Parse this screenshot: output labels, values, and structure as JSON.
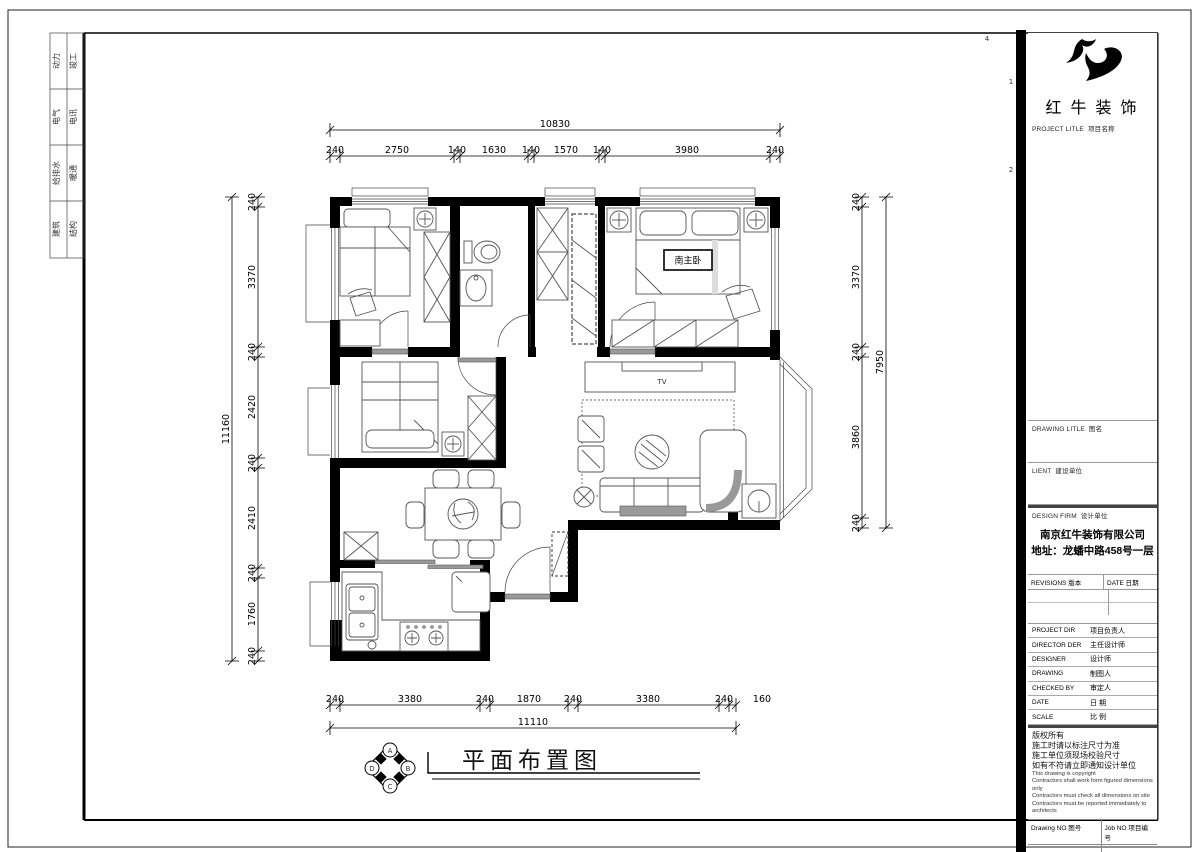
{
  "drawing": {
    "sheet_title": "平面布置图",
    "master_bedroom_label": "南主卧",
    "tv_label": "TV"
  },
  "dims": {
    "top": {
      "total": "10830",
      "segments": [
        "240",
        "2750",
        "140",
        "1630",
        "140",
        "1570",
        "140",
        "3980",
        "240"
      ]
    },
    "bottom": {
      "total": "11110",
      "segments": [
        "240",
        "3380",
        "240",
        "1870",
        "240",
        "3380",
        "240",
        "160"
      ]
    },
    "left": {
      "total": "11160",
      "segments": [
        "240",
        "3370",
        "240",
        "2420",
        "240",
        "2410",
        "240",
        "1760",
        "240"
      ]
    },
    "right": {
      "total": "7950",
      "segments": [
        "240",
        "3370",
        "240",
        "3860",
        "240"
      ]
    }
  },
  "brand": {
    "name": "红牛装饰"
  },
  "titleblock": {
    "project_title": {
      "en": "PROJECT LITLE",
      "cn": "项目名称"
    },
    "drawing_title": {
      "en": "DRAWING LITLE",
      "cn": "图名"
    },
    "client": {
      "en": "LIENT",
      "cn": "建设单位"
    },
    "design_firm": {
      "en": "DESIGN FIRM",
      "cn": "设计单位"
    },
    "company": {
      "name": "南京红牛装饰有限公司",
      "address": "地址：龙蟠中路458号一层"
    },
    "revisions": {
      "rev_en": "REVISIONS",
      "rev_cn": "版本",
      "date_en": "DATE",
      "date_cn": "日期"
    },
    "personnel": [
      {
        "en": "PROJECT DIR",
        "cn": "项目负责人"
      },
      {
        "en": "DIRECTOR DER",
        "cn": "主任设计师"
      },
      {
        "en": "DESIGNER",
        "cn": "设计师"
      },
      {
        "en": "DRAWING",
        "cn": "制图人"
      },
      {
        "en": "CHECKED BY",
        "cn": "审定人"
      },
      {
        "en": "DATE",
        "cn": "日  期"
      },
      {
        "en": "SCALE",
        "cn": "比  例"
      }
    ],
    "notes": {
      "cn": [
        "版权所有",
        "施工时请以标注尺寸为准",
        "施工单位须现场校验尺寸",
        "如有不符请立即通知设计单位"
      ],
      "en": [
        "This drawing is copyright",
        "Contractors shall work form figured dimensions only",
        "Contractors must check all dimensions on site",
        "Contractors must be reported immediately to architects"
      ]
    },
    "footer": {
      "drawing_no_en": "Drawing NO",
      "drawing_no_cn": "图号",
      "job_no_en": "Job NO",
      "job_no_cn": "项目编号"
    }
  },
  "signoff": {
    "rows": [
      [
        "动力",
        "竣工"
      ],
      [
        "电气",
        "电讯"
      ],
      [
        "给排水",
        "暖通"
      ],
      [
        "建筑",
        "结构"
      ]
    ]
  },
  "compass": {
    "letters": [
      "A",
      "B",
      "C",
      "D"
    ]
  },
  "grid_refs": [
    "4",
    "1",
    "2"
  ],
  "colors": {
    "line": "#000000",
    "gray_fill": "#9a9a9a",
    "paper": "#ffffff"
  }
}
